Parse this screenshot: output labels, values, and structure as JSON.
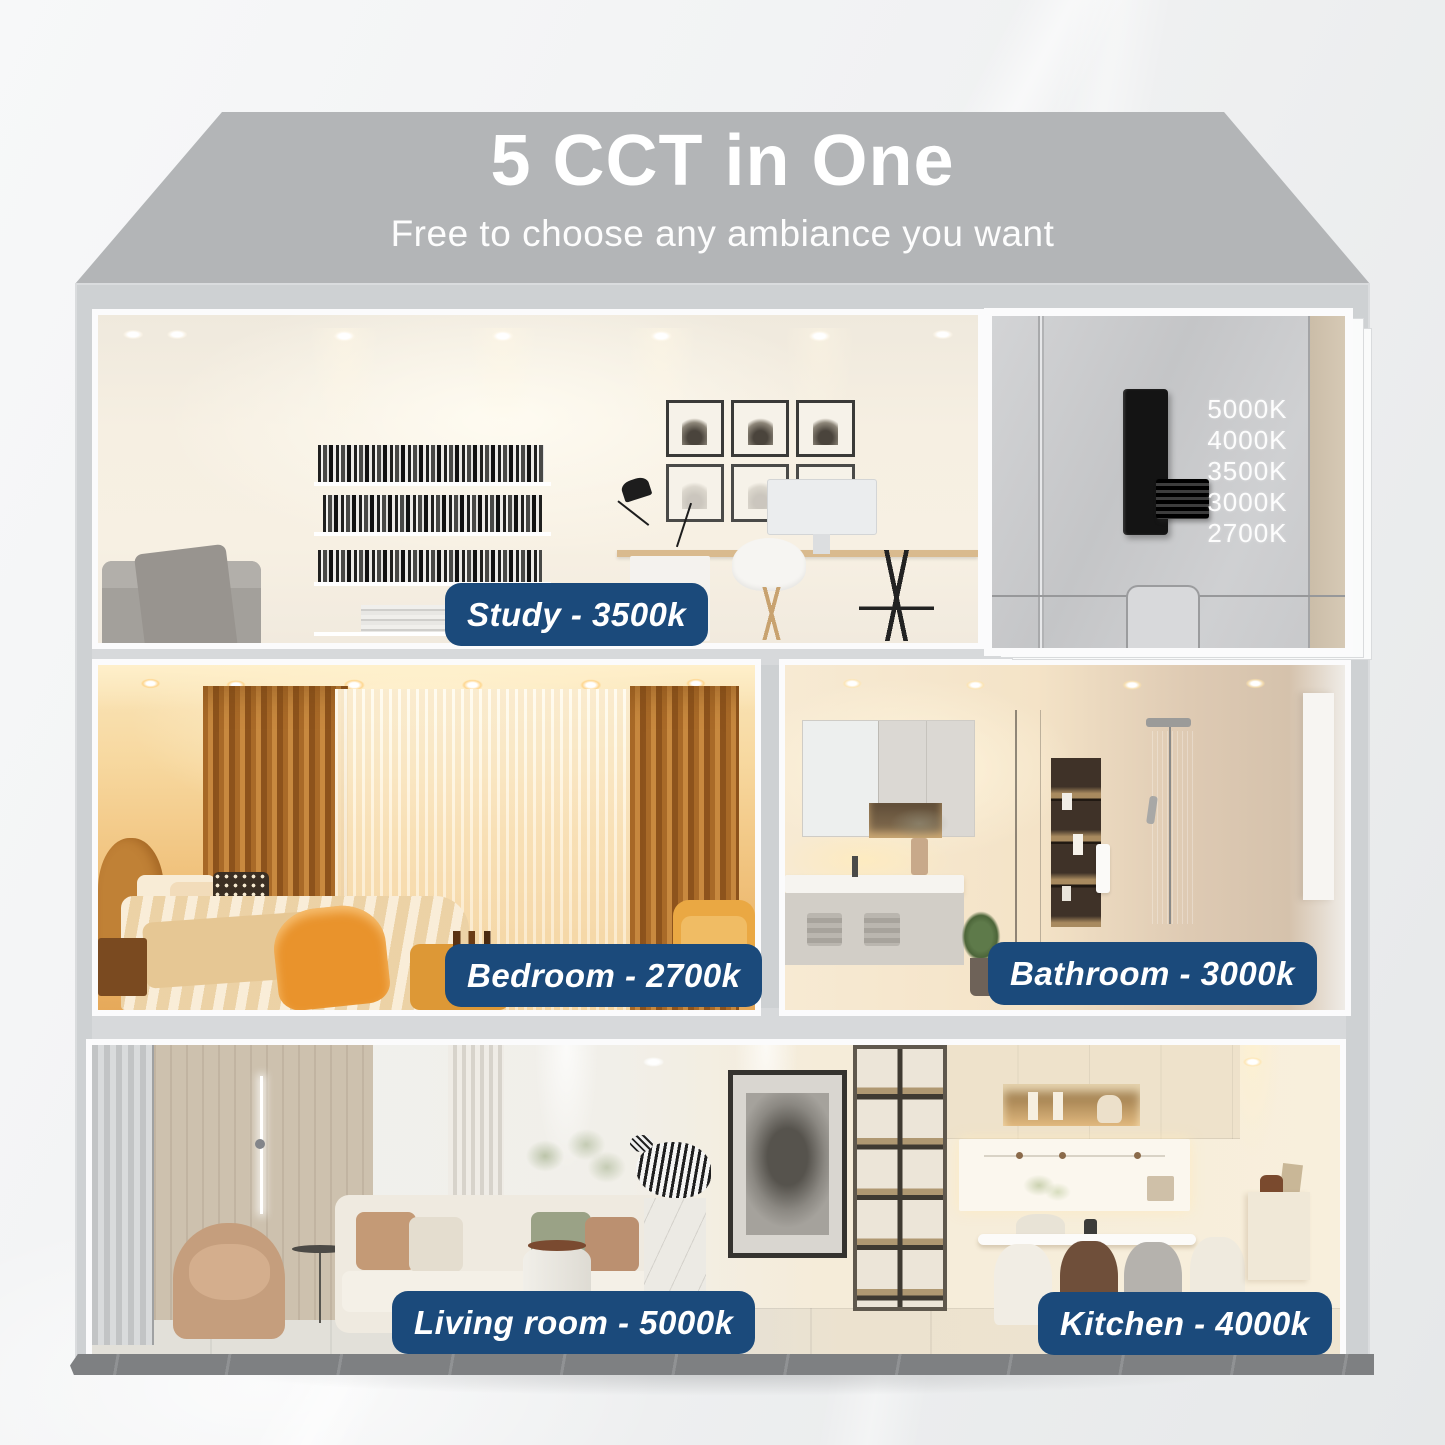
{
  "header": {
    "title": "5 CCT in One",
    "subtitle": "Free to choose any ambiance you want"
  },
  "cct_switch": {
    "options": [
      "5000K",
      "4000K",
      "3500K",
      "3000K",
      "2700K"
    ]
  },
  "room_labels": {
    "study": "Study - 3500k",
    "bedroom": "Bedroom - 2700k",
    "bathroom": "Bathroom - 3000k",
    "living": "Living room - 5000k",
    "kitchen": "Kitchen - 4000k"
  },
  "colors": {
    "label_background": "#1b4a7b",
    "label_text": "#ffffff",
    "roof_gray": "#b3b5b7",
    "wall_gray": "#ced1d3",
    "floor_slab": "#7e8082",
    "warm_2700k": "#e7aa58",
    "warm_3000k": "#ecd9bd",
    "neutral_3500k": "#f5eee1",
    "neutral_4000k": "#f5ead6",
    "cool_5000k": "#f0f1f0"
  }
}
